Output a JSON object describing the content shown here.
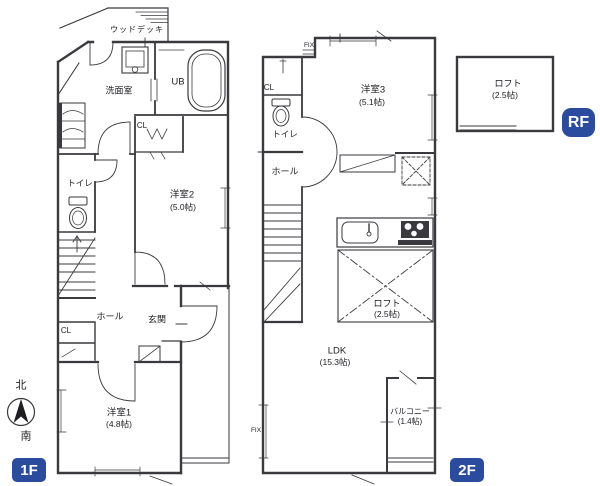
{
  "badges": {
    "f1": "1F",
    "f2": "2F",
    "rf": "RF"
  },
  "compass": {
    "north": "北",
    "south": "南"
  },
  "f1": {
    "wood_deck": "ウッドデッキ",
    "washroom": "洗面室",
    "unit_bath": "UB",
    "closet_upper": "CL",
    "toilet": "トイレ",
    "room2_name": "洋室2",
    "room2_size": "(5.0帖)",
    "hall": "ホール",
    "entrance": "玄関",
    "closet_lower": "CL",
    "room1_name": "洋室1",
    "room1_size": "(4.8帖)"
  },
  "f2": {
    "fix_top": "FIX",
    "closet": "CL",
    "toilet": "トイレ",
    "hall": "ホール",
    "room3_name": "洋室3",
    "room3_size": "(5.1帖)",
    "loft_name": "ロフト",
    "loft_size": "(2.5帖)",
    "ldk_name": "LDK",
    "ldk_size": "(15.3帖)",
    "balcony_name": "バルコニー",
    "balcony_size": "(1.4帖)",
    "fix_left": "FIX"
  },
  "rf": {
    "loft_name": "ロフト",
    "loft_size": "(2.5帖)"
  },
  "colors": {
    "badge_bg": "#2b4c9e",
    "badge_text": "#ffffff",
    "line": "#3a3a3e",
    "text": "#1d1d22",
    "background": "#ffffff"
  }
}
